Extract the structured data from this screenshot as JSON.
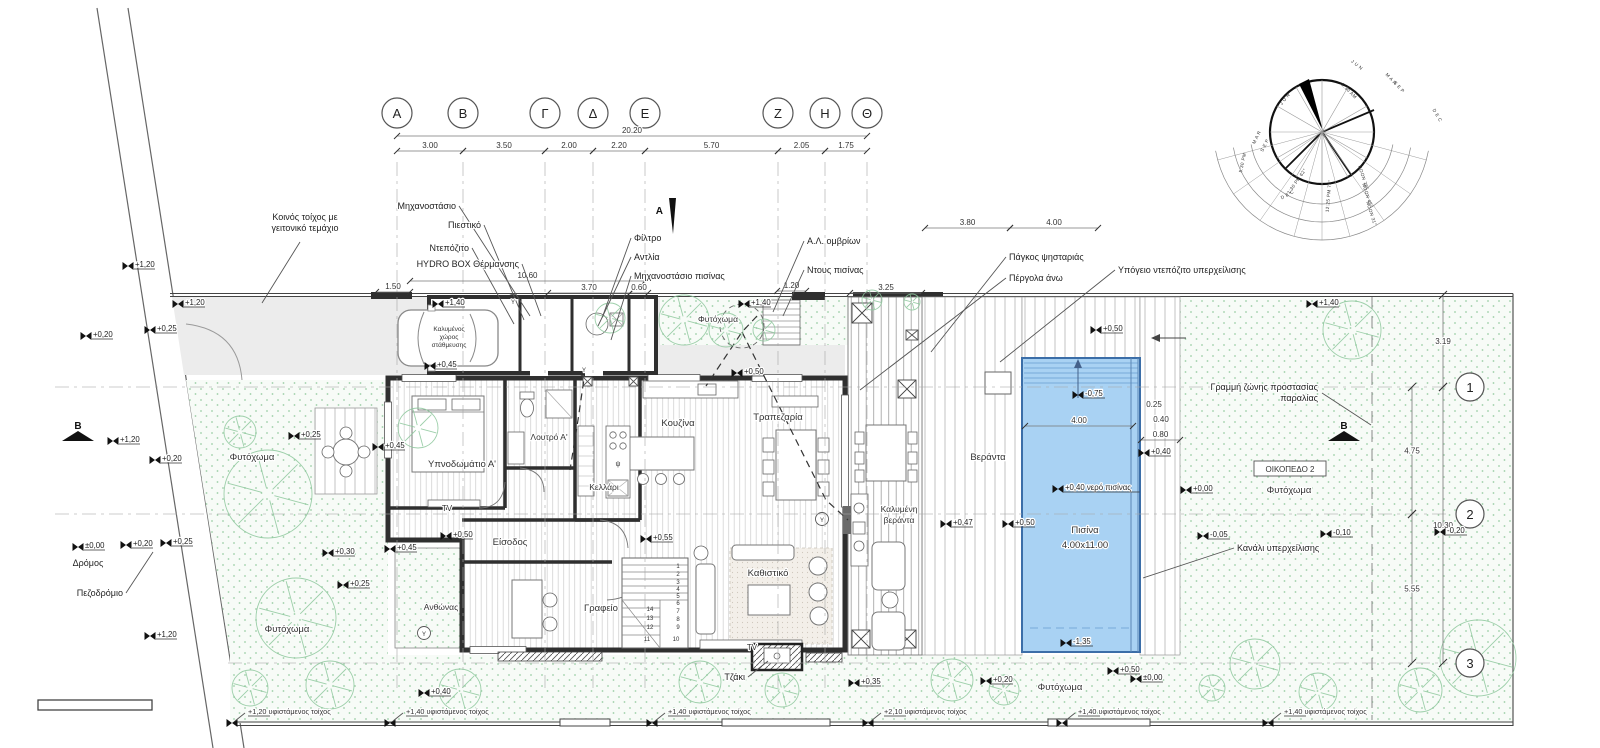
{
  "colors": {
    "wall": "#2f2f2f",
    "pool_water": "#a9d2f3",
    "pool_edge": "#3b6ea8",
    "vegetation": "#8cc79b",
    "drive": "#ececec",
    "grid": "#a5a5a5",
    "ink": "#333333"
  },
  "grid": {
    "columns": [
      {
        "label": "Α",
        "x": 397
      },
      {
        "label": "Β",
        "x": 463
      },
      {
        "label": "Γ",
        "x": 545
      },
      {
        "label": "Δ",
        "x": 593
      },
      {
        "label": "Ε",
        "x": 645
      },
      {
        "label": "Ζ",
        "x": 778
      },
      {
        "label": "Η",
        "x": 825
      },
      {
        "label": "Θ",
        "x": 867
      }
    ],
    "rows": [
      {
        "label": "1",
        "y": 387,
        "x1": 55
      },
      {
        "label": "2",
        "y": 514,
        "x1": 55
      },
      {
        "label": "3",
        "y": 663,
        "x1": 228
      }
    ]
  },
  "dims": [
    {
      "text": "20.20",
      "x1": 397,
      "x2": 867,
      "y": 133
    },
    {
      "text": "3.00",
      "x1": 397,
      "x2": 463,
      "y": 148
    },
    {
      "text": "3.50",
      "x1": 463,
      "x2": 545,
      "y": 148
    },
    {
      "text": "2.00",
      "x1": 545,
      "x2": 593,
      "y": 148
    },
    {
      "text": "2.20",
      "x1": 593,
      "x2": 645,
      "y": 148
    },
    {
      "text": "5.70",
      "x1": 645,
      "x2": 778,
      "y": 148
    },
    {
      "text": "2.05",
      "x1": 778,
      "x2": 825,
      "y": 148
    },
    {
      "text": "1.75",
      "x1": 825,
      "x2": 867,
      "y": 148
    },
    {
      "text": "1.50",
      "x1": 376,
      "x2": 410,
      "y": 289
    },
    {
      "text": "10.60",
      "x1": 410,
      "x2": 645,
      "y": 278
    },
    {
      "text": "3.70",
      "x1": 548,
      "x2": 630,
      "y": 290
    },
    {
      "text": "0.60",
      "x1": 630,
      "x2": 648,
      "y": 290
    },
    {
      "text": "1.20",
      "x1": 777,
      "x2": 806,
      "y": 288
    },
    {
      "text": "3.25",
      "x1": 850,
      "x2": 922,
      "y": 290
    },
    {
      "text": "3.80",
      "x1": 925,
      "x2": 1010,
      "y": 225
    },
    {
      "text": "4.00",
      "x1": 1010,
      "x2": 1098,
      "y": 225
    },
    {
      "text": "4.00",
      "x1": 1025,
      "x2": 1133,
      "y": 423
    },
    {
      "text": "0.25",
      "x": 1154,
      "y": 407
    },
    {
      "text": "0.40",
      "x": 1161,
      "y": 422
    },
    {
      "text": "0.80",
      "x1": 1141,
      "x2": 1180,
      "y": 437
    },
    {
      "text": "3.19",
      "v": 1,
      "x": 1443,
      "y1": 295,
      "y2": 387
    },
    {
      "text": "4.75",
      "v": 1,
      "x": 1412,
      "y1": 387,
      "y2": 514
    },
    {
      "text": "10.30",
      "v": 1,
      "x": 1443,
      "y1": 387,
      "y2": 663
    },
    {
      "text": "5.55",
      "v": 1,
      "x": 1412,
      "y1": 514,
      "y2": 663
    }
  ],
  "annotations": [
    {
      "t": "Κοινός τοίχος με\nγειτονικό τεμάχιο",
      "x": 305,
      "y": 220,
      "a": "middle",
      "l": [
        [
          300,
          242
        ],
        [
          262,
          303
        ]
      ]
    },
    {
      "t": "Μηχανοστάσιο",
      "x": 456,
      "y": 209,
      "a": "end",
      "l": [
        [
          459,
          206
        ],
        [
          530,
          316
        ]
      ]
    },
    {
      "t": "Πιεστικό",
      "x": 481,
      "y": 228,
      "a": "end",
      "l": [
        [
          484,
          225
        ],
        [
          524,
          320
        ]
      ]
    },
    {
      "t": "Ντεπόζιτο",
      "x": 469,
      "y": 251,
      "a": "end",
      "l": [
        [
          472,
          248
        ],
        [
          514,
          324
        ]
      ]
    },
    {
      "t": "HYDRO BOX Θέρμανσης",
      "x": 519,
      "y": 267,
      "a": "end",
      "l": [
        [
          522,
          264
        ],
        [
          541,
          316
        ]
      ]
    },
    {
      "t": "Φίλτρο",
      "x": 634,
      "y": 241,
      "a": "start",
      "l": [
        [
          631,
          238
        ],
        [
          602,
          318
        ]
      ]
    },
    {
      "t": "Αντλία",
      "x": 634,
      "y": 260,
      "a": "start",
      "l": [
        [
          631,
          257
        ],
        [
          598,
          326
        ]
      ]
    },
    {
      "t": "Μηχανοστάσιο πισίνας",
      "x": 634,
      "y": 279,
      "a": "start",
      "l": [
        [
          631,
          276
        ],
        [
          611,
          340
        ]
      ]
    },
    {
      "t": "Α.Λ. ομβρίων",
      "x": 807,
      "y": 244,
      "a": "start",
      "l": [
        [
          804,
          241
        ],
        [
          773,
          312
        ]
      ]
    },
    {
      "t": "Ντους πισίνας",
      "x": 807,
      "y": 273,
      "a": "start",
      "l": [
        [
          804,
          270
        ],
        [
          783,
          316
        ]
      ]
    },
    {
      "t": "Πάγκος ψησταριάς",
      "x": 1009,
      "y": 260,
      "a": "start",
      "l": [
        [
          1006,
          257
        ],
        [
          931,
          352
        ]
      ]
    },
    {
      "t": "Πέργολα άνω",
      "x": 1009,
      "y": 281,
      "a": "start",
      "l": [
        [
          1006,
          278
        ],
        [
          860,
          390
        ]
      ]
    },
    {
      "t": "Υπόγειο ντεπόζιτο υπερχείλισης",
      "x": 1118,
      "y": 273,
      "a": "start",
      "l": [
        [
          1115,
          270
        ],
        [
          1000,
          362
        ]
      ]
    },
    {
      "t": "Γραμμή ζώνης προστασίας\nπαραλίας",
      "x": 1318,
      "y": 390,
      "a": "end",
      "l": [
        [
          1322,
          393
        ],
        [
          1371,
          425
        ]
      ]
    },
    {
      "t": "Κανάλι υπερχείλισης",
      "x": 1237,
      "y": 551,
      "a": "start",
      "l": [
        [
          1234,
          548
        ],
        [
          1143,
          578
        ]
      ]
    },
    {
      "t": "Τζάκι",
      "x": 745,
      "y": 680,
      "a": "end",
      "l": [
        [
          748,
          677
        ],
        [
          768,
          661
        ]
      ]
    },
    {
      "t": "Πεζοδρόμιο",
      "x": 123,
      "y": 596,
      "a": "end",
      "l": [
        [
          126,
          593
        ],
        [
          153,
          552
        ]
      ]
    },
    {
      "t": "Δρόμος",
      "x": 88,
      "y": 566,
      "a": "middle"
    },
    {
      "t": "A",
      "x": 663,
      "y": 214,
      "a": "end",
      "cls": "sec"
    },
    {
      "t": "B",
      "x": 78,
      "y": 429,
      "a": "middle",
      "cls": "sec"
    },
    {
      "t": "B",
      "x": 1344,
      "y": 429,
      "a": "middle",
      "cls": "sec"
    }
  ],
  "rooms": [
    {
      "t": "Υπνοδωμάτιο Α'",
      "x": 462,
      "y": 467
    },
    {
      "t": "Λουτρό Α'",
      "x": 549,
      "y": 440,
      "s": 8.5
    },
    {
      "t": "Κελλάρι",
      "x": 604,
      "y": 490,
      "s": 8.5
    },
    {
      "t": "Κουζίνα",
      "x": 678,
      "y": 426
    },
    {
      "t": "Τραπεζαρία",
      "x": 778,
      "y": 420
    },
    {
      "t": "Είσοδος",
      "x": 510,
      "y": 545
    },
    {
      "t": "Γραφείο",
      "x": 601,
      "y": 611
    },
    {
      "t": "Καθιστικό",
      "x": 768,
      "y": 576
    },
    {
      "t": "Ανθώνας",
      "x": 441,
      "y": 610,
      "s": 8.5
    },
    {
      "t": "Βεράντα",
      "x": 988,
      "y": 460
    },
    {
      "t": "Καλυμένη",
      "x": 899,
      "y": 512,
      "s": 8.5
    },
    {
      "t": "βεράντα",
      "x": 899,
      "y": 523,
      "s": 8.5
    },
    {
      "t": "Πισίνα",
      "x": 1085,
      "y": 533
    },
    {
      "t": "4.00x11.00",
      "x": 1085,
      "y": 548
    },
    {
      "t": "Φυτόχωμα",
      "x": 252,
      "y": 460
    },
    {
      "t": "Φυτόχωμα",
      "x": 287,
      "y": 632
    },
    {
      "t": "Φυτόχωμα",
      "x": 718,
      "y": 322,
      "s": 8.5
    },
    {
      "t": "Φυτόχωμα",
      "x": 1060,
      "y": 690
    },
    {
      "t": "Φυτόχωμα",
      "x": 1289,
      "y": 493
    },
    {
      "t": "ΟΙΚΟΠΕΔΟ 2",
      "x": 1290,
      "y": 472,
      "s": 8
    },
    {
      "t": "TV",
      "x": 447,
      "y": 511,
      "s": 8
    },
    {
      "t": "TV",
      "x": 752,
      "y": 650,
      "s": 8
    },
    {
      "t": "ψ",
      "x": 618,
      "y": 466,
      "s": 7
    },
    {
      "t": "Καλυμένος",
      "x": 449,
      "y": 331,
      "s": 6.5
    },
    {
      "t": "χώρος",
      "x": 449,
      "y": 339,
      "s": 6.5
    },
    {
      "t": "στάθμευσης",
      "x": 449,
      "y": 347,
      "s": 6.5
    },
    {
      "t": "Υ",
      "x": 513,
      "y": 304,
      "s": 6
    },
    {
      "t": "Υ",
      "x": 584,
      "y": 372,
      "s": 6
    },
    {
      "t": "Υ",
      "x": 822,
      "y": 522,
      "s": 6
    },
    {
      "t": "Υ",
      "x": 424,
      "y": 636,
      "s": 6
    }
  ],
  "spots": [
    {
      "t": "+1,20",
      "x": 128,
      "y": 266
    },
    {
      "t": "+1,20",
      "x": 178,
      "y": 304
    },
    {
      "t": "+0,20",
      "x": 86,
      "y": 336
    },
    {
      "t": "+0,25",
      "x": 150,
      "y": 330
    },
    {
      "t": "+1,40",
      "x": 438,
      "y": 304
    },
    {
      "t": "+1,40",
      "x": 744,
      "y": 304
    },
    {
      "t": "+1,40",
      "x": 1312,
      "y": 304
    },
    {
      "t": "+0,45",
      "x": 430,
      "y": 366
    },
    {
      "t": "+0,50",
      "x": 737,
      "y": 373
    },
    {
      "t": "+0,50",
      "x": 1096,
      "y": 330
    },
    {
      "t": "+1,20",
      "x": 113,
      "y": 441
    },
    {
      "t": "+0,20",
      "x": 155,
      "y": 460
    },
    {
      "t": "+0,25",
      "x": 294,
      "y": 436
    },
    {
      "t": "+0,45",
      "x": 378,
      "y": 447
    },
    {
      "t": "-0,75",
      "x": 1078,
      "y": 395
    },
    {
      "t": "+0,40",
      "x": 1144,
      "y": 453
    },
    {
      "t": "+0,40 νερό πισίνας",
      "x": 1058,
      "y": 489
    },
    {
      "t": "+0,00",
      "x": 1186,
      "y": 490
    },
    {
      "t": "+0,47",
      "x": 946,
      "y": 524
    },
    {
      "t": "+0,50",
      "x": 1008,
      "y": 524
    },
    {
      "t": "-0,05",
      "x": 1203,
      "y": 536
    },
    {
      "t": "-0,10",
      "x": 1326,
      "y": 534
    },
    {
      "t": "-0,20",
      "x": 1440,
      "y": 532
    },
    {
      "t": "±0,00",
      "x": 78,
      "y": 547
    },
    {
      "t": "+0,20",
      "x": 126,
      "y": 545
    },
    {
      "t": "+0,25",
      "x": 166,
      "y": 543
    },
    {
      "t": "+0,30",
      "x": 328,
      "y": 553
    },
    {
      "t": "+0,25",
      "x": 343,
      "y": 585
    },
    {
      "t": "+0,45",
      "x": 390,
      "y": 549
    },
    {
      "t": "+0,50",
      "x": 446,
      "y": 536
    },
    {
      "t": "+0,55",
      "x": 646,
      "y": 539
    },
    {
      "t": "+1,20",
      "x": 150,
      "y": 636
    },
    {
      "t": "-1,35",
      "x": 1066,
      "y": 643
    },
    {
      "t": "+0,50",
      "x": 1113,
      "y": 671
    },
    {
      "t": "+0,35",
      "x": 854,
      "y": 683
    },
    {
      "t": "+0,20",
      "x": 986,
      "y": 681
    },
    {
      "t": "±0,00",
      "x": 1136,
      "y": 679
    },
    {
      "t": "+0,40",
      "x": 424,
      "y": 693
    }
  ],
  "wall_notes": [
    {
      "t": "+1,20 υφιστάμενος τοίχος",
      "x": 232
    },
    {
      "t": "+1,40 υφιστάμενος τοίχος",
      "x": 390
    },
    {
      "t": "+1,40 υφιστάμενος τοίχος",
      "x": 652
    },
    {
      "t": "+2,10 υφιστάμενος τοίχος",
      "x": 868
    },
    {
      "t": "+1,40 υφιστάμενος τοίχος",
      "x": 1062
    },
    {
      "t": "+1,40 υφιστάμενος τοίχος",
      "x": 1268
    }
  ],
  "stairs": [
    [
      "1",
      678,
      568
    ],
    [
      "2",
      678,
      576
    ],
    [
      "3",
      678,
      584
    ],
    [
      "4",
      678,
      591
    ],
    [
      "5",
      678,
      598
    ],
    [
      "6",
      678,
      605
    ],
    [
      "7",
      678,
      613
    ],
    [
      "8",
      678,
      621
    ],
    [
      "9",
      678,
      629
    ],
    [
      "10",
      676,
      641
    ],
    [
      "11",
      647,
      641
    ],
    [
      "12",
      650,
      629
    ],
    [
      "13",
      650,
      620
    ],
    [
      "14",
      650,
      611
    ]
  ],
  "trees": [
    [
      268,
      494,
      44
    ],
    [
      296,
      618,
      40
    ],
    [
      240,
      432,
      16
    ],
    [
      330,
      685,
      24
    ],
    [
      250,
      688,
      18
    ],
    [
      418,
      428,
      20
    ],
    [
      610,
      318,
      15
    ],
    [
      684,
      320,
      25
    ],
    [
      726,
      330,
      17
    ],
    [
      764,
      330,
      11
    ],
    [
      460,
      690,
      21
    ],
    [
      700,
      682,
      21
    ],
    [
      782,
      690,
      17
    ],
    [
      952,
      680,
      21
    ],
    [
      1004,
      690,
      15
    ],
    [
      1352,
      330,
      29
    ],
    [
      1478,
      658,
      38
    ],
    [
      1420,
      690,
      22
    ],
    [
      1255,
      664,
      25
    ],
    [
      1318,
      692,
      19
    ],
    [
      1212,
      688,
      13
    ],
    [
      872,
      300,
      10
    ],
    [
      912,
      302,
      8
    ]
  ],
  "sun": {
    "labels": [
      [
        "J U N",
        1286,
        100,
        -52
      ],
      [
        "M A R",
        1258,
        138,
        -64
      ],
      [
        "S E P",
        1266,
        146,
        -64
      ],
      [
        "D E C",
        1288,
        196,
        -28
      ],
      [
        "J U N",
        1356,
        66,
        38
      ],
      [
        "M A R",
        1390,
        80,
        48
      ],
      [
        "S E P",
        1398,
        88,
        48
      ],
      [
        "D E C",
        1436,
        116,
        60
      ],
      [
        "5:30 PM",
        1244,
        163,
        -78
      ],
      [
        "1:30 PM 62°",
        1298,
        182,
        -55
      ],
      [
        "12:25 PM 75°",
        1330,
        196,
        -85
      ],
      [
        "NOON 78°",
        1362,
        178,
        72
      ],
      [
        "NOON 45°",
        1366,
        196,
        72
      ],
      [
        "NOON 31°",
        1370,
        214,
        72
      ],
      [
        "5:30 AM",
        1348,
        92,
        45
      ]
    ]
  }
}
